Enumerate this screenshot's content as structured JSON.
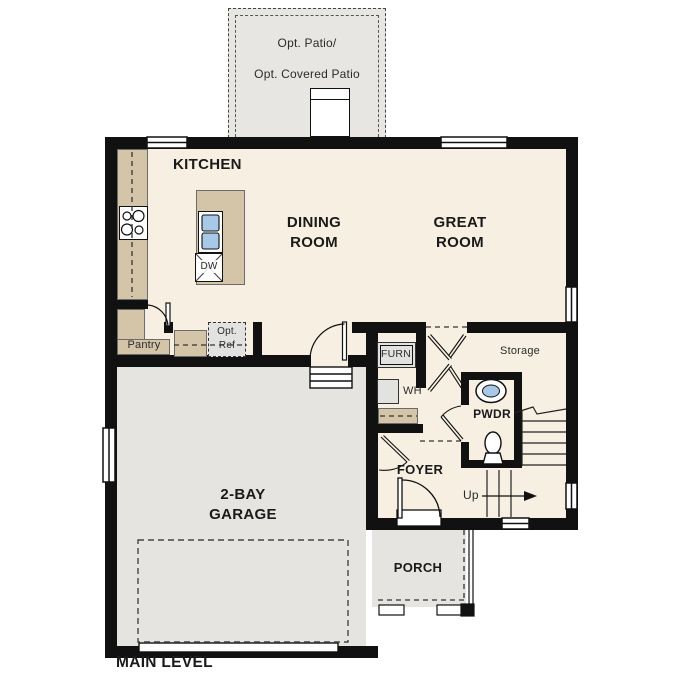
{
  "title": "MAIN LEVEL",
  "patio": {
    "label_line1": "Opt. Patio/",
    "label_line2": "Opt. Covered Patio"
  },
  "rooms": {
    "kitchen": {
      "label": "KITCHEN"
    },
    "dining": {
      "label": "DINING\nROOM"
    },
    "great": {
      "label": "GREAT\nROOM"
    },
    "garage": {
      "label": "2-BAY\nGARAGE"
    },
    "foyer": {
      "label": "FOYER"
    },
    "powder": {
      "label": "PWDR"
    },
    "porch": {
      "label": "PORCH"
    },
    "storage": {
      "label": "Storage"
    },
    "pantry": {
      "label": "Pantry"
    }
  },
  "fixtures": {
    "dishwasher": "DW",
    "furnace": "FURN",
    "water_heater": "WH",
    "optional_refrigerator": "Opt.\nRef",
    "stairs_direction": "Up"
  },
  "colors": {
    "wall": "#111111",
    "floor": "#f7f0e2",
    "counter": "#d4c5a8",
    "concrete": "#e5e4e1",
    "appliance_gray": "#e2e2e0",
    "sink_blue": "#a8c8e8"
  }
}
